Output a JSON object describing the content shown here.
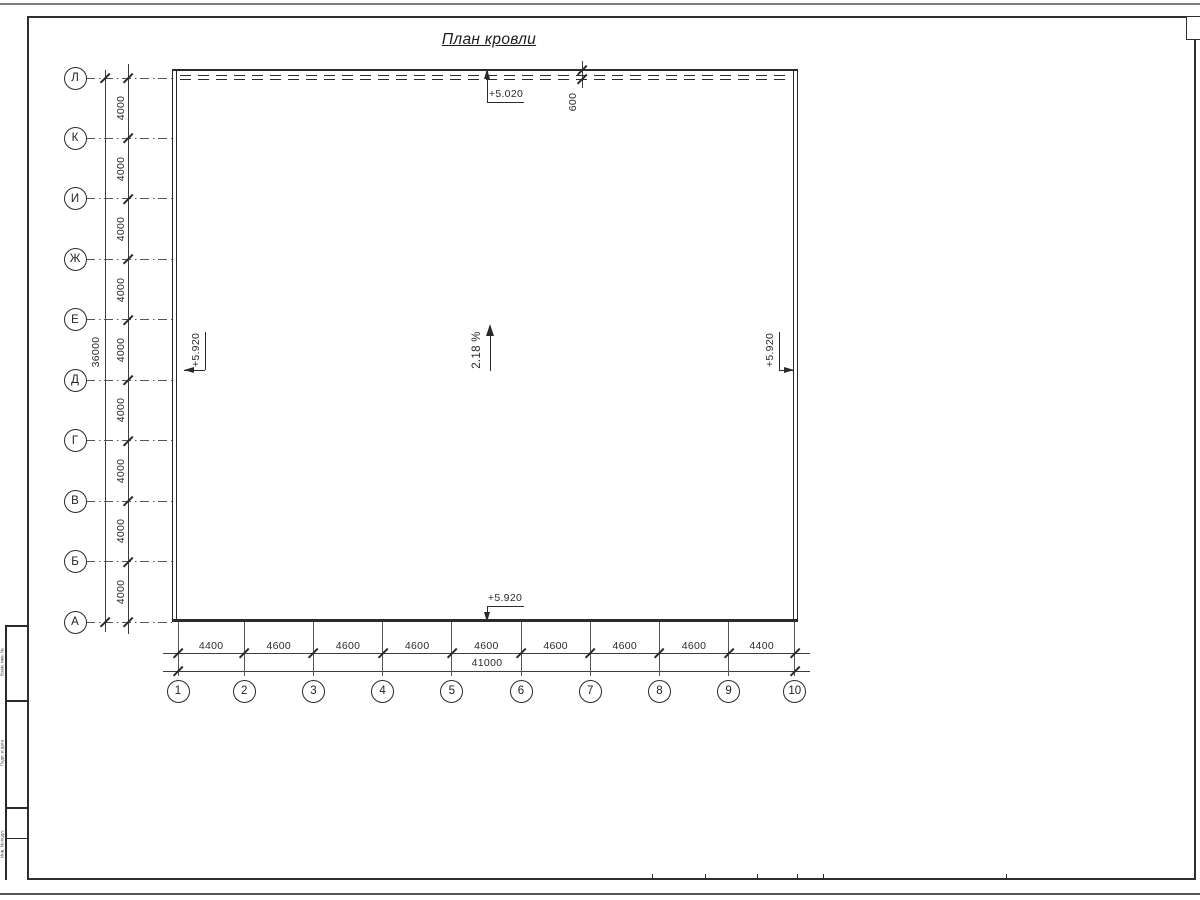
{
  "sheet": {
    "title": "План кровли",
    "stamp_side_labels": [
      "Взам. инв. №",
      "Подп. и дата",
      "Инв. № подл."
    ]
  },
  "axes": {
    "rows": {
      "labels": [
        "Л",
        "К",
        "И",
        "Ж",
        "Е",
        "Д",
        "Г",
        "В",
        "Б",
        "А"
      ],
      "span_labels": [
        "4000",
        "4000",
        "4000",
        "4000",
        "4000",
        "4000",
        "4000",
        "4000",
        "4000"
      ],
      "total_label": "36000"
    },
    "cols": {
      "labels": [
        "1",
        "2",
        "3",
        "4",
        "5",
        "6",
        "7",
        "8",
        "9",
        "10"
      ],
      "span_labels": [
        "4400",
        "4600",
        "4600",
        "4600",
        "4600",
        "4600",
        "4600",
        "4600",
        "4400"
      ],
      "total_label": "41000"
    }
  },
  "marks": {
    "elev_top": "+5.020",
    "elev_left": "+5.920",
    "elev_right": "+5.920",
    "elev_bottom": "+5.920",
    "slope": "2.18 %",
    "parapet_offset": "600"
  },
  "colors": {
    "line": "#2a2a2a",
    "dim": "#3c3c3c",
    "frame": "#2f2f2f"
  }
}
